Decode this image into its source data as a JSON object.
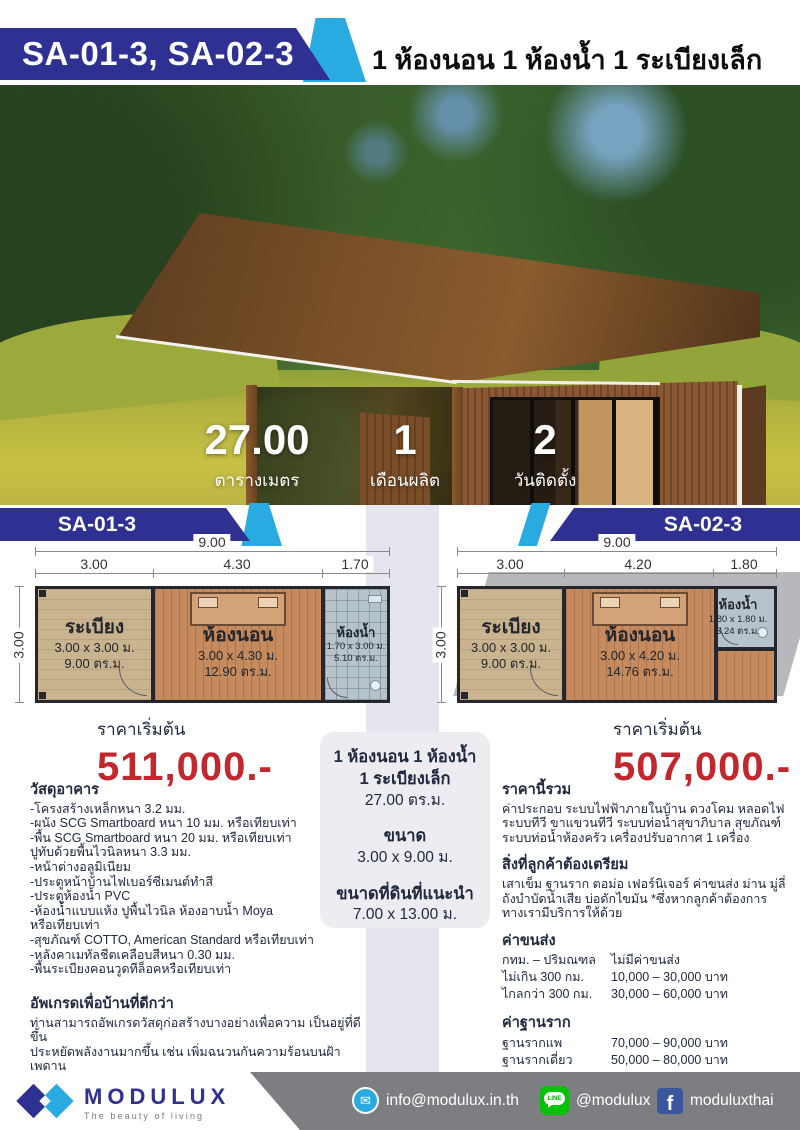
{
  "header": {
    "model_codes": "SA-01-3, SA-02-3",
    "title": "1 ห้องนอน 1 ห้องน้ำ 1 ระเบียงเล็ก"
  },
  "hero": {
    "stats": [
      {
        "value": "27.00",
        "label": "ตารางเมตร"
      },
      {
        "value": "1",
        "label": "เดือนผลิต"
      },
      {
        "value": "2",
        "label": "วันติดตั้ง"
      }
    ]
  },
  "plans": [
    {
      "code": "SA-01-3",
      "total_width": "9.00",
      "side": "3.00",
      "segments": [
        "3.00",
        "4.30",
        "1.70"
      ],
      "rooms": [
        {
          "name": "ระเบียง",
          "dim": "3.00 x 3.00 ม.",
          "area": "9.00 ตร.ม."
        },
        {
          "name": "ห้องนอน",
          "dim": "3.00 x 4.30 ม.",
          "area": "12.90 ตร.ม."
        },
        {
          "name": "ห้องน้ำ",
          "dim": "1.70 x 3.00 ม.",
          "area": "5.10 ตร.ม."
        }
      ],
      "price_label": "ราคาเริ่มต้น",
      "price": "511,000.-"
    },
    {
      "code": "SA-02-3",
      "total_width": "9.00",
      "side": "3.00",
      "segments": [
        "3.00",
        "4.20",
        "1.80"
      ],
      "rooms": [
        {
          "name": "ระเบียง",
          "dim": "3.00 x 3.00 ม.",
          "area": "9.00 ตร.ม."
        },
        {
          "name": "ห้องนอน",
          "dim": "3.00 x 4.20 ม.",
          "area": "14.76 ตร.ม."
        },
        {
          "name": "ห้องน้ำ",
          "dim": "1.80 x 1.80 ม.",
          "area": "3.24 ตร.ม."
        }
      ],
      "price_label": "ราคาเริ่มต้น",
      "price": "507,000.-"
    }
  ],
  "summary_box": {
    "line1": "1 ห้องนอน 1 ห้องน้ำ",
    "line2": "1 ระเบียงเล็ก",
    "area": "27.00 ตร.ม.",
    "size_label": "ขนาด",
    "size": "3.00 x 9.00 ม.",
    "land_label": "ขนาดที่ดินที่แนะนำ",
    "land": "7.00 x 13.00 ม."
  },
  "materials": {
    "title": "วัสดุอาคาร",
    "items": [
      "-โครงสร้างเหล็กหนา 3.2 มม.",
      "-ผนัง SCG Smartboard หนา 10 มม. หรือเทียบเท่า",
      "-พื้น SCG Smartboard หนา 20 มม. หรือเทียบเท่า",
      "ปูทับด้วยพื้นไวนิลหนา 3.3 มม.",
      "-หน้าต่างอลูมิเนียม",
      "-ประตูหน้าบ้านไฟเบอร์ซีเมนต์ทำสี",
      "-ประตูห้องน้ำ PVC",
      "-ห้องน้ำแบบแห้ง ปูพื้นไวนิล ห้องอาบน้ำ Moya",
      "หรือเทียบเท่า",
      "-สุขภัณฑ์ COTTO, American Standard หรือเทียบเท่า",
      "-หลังคาเมทัลชีตเคลือบสีหนา 0.30 มม.",
      "-พื้นระเบียงคอนวูดทีล็อคหรือเทียบเท่า"
    ]
  },
  "upgrade": {
    "title": "อัพเกรดเพื่อบ้านที่ดีกว่า",
    "body": "ท่านสามารถอัพเกรดวัสดุก่อสร้างบางอย่างเพื่อความ เป็นอยู่ที่ดีขึ้น\nประหยัดพลังงานมากขึ้น เช่น เพิ่มฉนวนกันความร้อนบนฝ้าเพดาน\nเพิ่มฉนวนกันความร้อนในผนัง เปลี่ยนแอร์เป็นระบบอินเวอร์เตอร์ เป็นต้น\nกรุณาปรึกษาสถาปนิกเราได้โดยตรง"
  },
  "included": {
    "title": "ราคานี้รวม",
    "body": "ค่าประกอบ ระบบไฟฟ้าภายในบ้าน ดวงโคม หลอดไฟ\nระบบทีวี ขาแขวนทีวี ระบบท่อน้ำสุขาภิบาล สุขภัณฑ์\nระบบท่อน้ำห้องครัว เครื่องปรับอากาศ 1 เครื่อง"
  },
  "prepare": {
    "title": "สิ่งที่ลูกค้าต้องเตรียม",
    "body": "เสาเข็ม ฐานราก ตอม่อ เฟอร์นิเจอร์ ค่าขนส่ง ม่าน มู่ลี่\nถังบำบัดน้ำเสีย บ่อดักไขมัน *ซึ่งหากลูกค้าต้องการ\nทางเรามีบริการให้ด้วย"
  },
  "shipping": {
    "title": "ค่าขนส่ง",
    "rows": [
      [
        "กทม. – ปริมณฑล",
        "ไม่มีค่าขนส่ง"
      ],
      [
        "ไม่เกิน 300 กม.",
        "10,000 – 30,000 บาท"
      ],
      [
        "ไกลกว่า 300 กม.",
        "30,000 – 60,000 บาท"
      ]
    ]
  },
  "foundation": {
    "title": "ค่าฐานราก",
    "rows": [
      [
        "ฐานรากแพ",
        "70,000 – 90,000 บาท"
      ],
      [
        "ฐานรากเดี่ยว",
        "50,000 – 80,000 บาท"
      ]
    ],
    "footnote": "*ราคานี้เป็นการประมาณคร่าวๆ ขึ้นอยู่กับพื้นที่และผู้รับจ้างแต่ละราย"
  },
  "footer": {
    "brand": "MODULUX",
    "tagline": "The beauty of living",
    "email": "info@modulux.in.th",
    "line_id": "@modulux",
    "facebook_id": "moduluxthai",
    "mail_icon_glyph": "✉",
    "facebook_icon_glyph": "f"
  },
  "colors": {
    "navy": "#2e3192",
    "accent_blue": "#29abe2",
    "price_red": "#c1272d",
    "band_lavender": "#e5e5ef",
    "line_green": "#00c300",
    "facebook_blue": "#3a579d",
    "footer_gray": "#7d7e82"
  }
}
